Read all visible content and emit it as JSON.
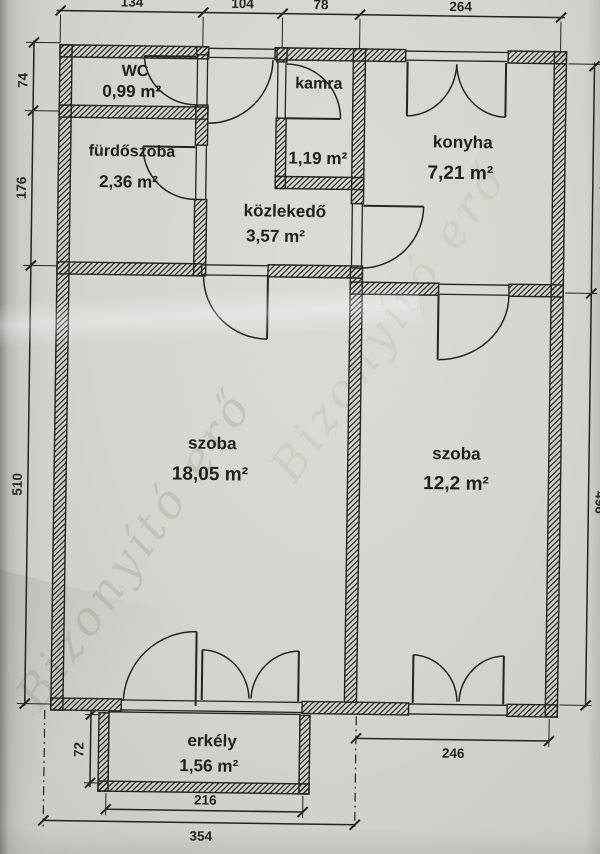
{
  "rooms": {
    "wc": {
      "name": "WC",
      "area": "0,99 m²"
    },
    "furdoszoba": {
      "name": "fürdőszoba",
      "area": "2,36 m²"
    },
    "kamra": {
      "name": "kamra",
      "area": "1,19 m²"
    },
    "kozlekedo": {
      "name": "közlekedő",
      "area": "3,57 m²"
    },
    "konyha": {
      "name": "konyha",
      "area": "7,21 m²"
    },
    "szoba_nagy": {
      "name": "szoba",
      "area": "18,05 m²"
    },
    "szoba_kis": {
      "name": "szoba",
      "area": "12,2 m²"
    },
    "erkely": {
      "name": "erkély",
      "area": "1,56 m²"
    }
  },
  "dims": {
    "top": [
      "134",
      "104",
      "78",
      "264"
    ],
    "left": [
      "74",
      "176",
      "510"
    ],
    "balcony_left": "72",
    "right": [
      "274",
      "496"
    ],
    "bottom_upper": "246",
    "bottom_mid": "216",
    "bottom_lower": "354"
  },
  "watermark": "Bizonyító erő",
  "colors": {
    "ink": "#26241f",
    "paper": "#d8d5d0"
  }
}
